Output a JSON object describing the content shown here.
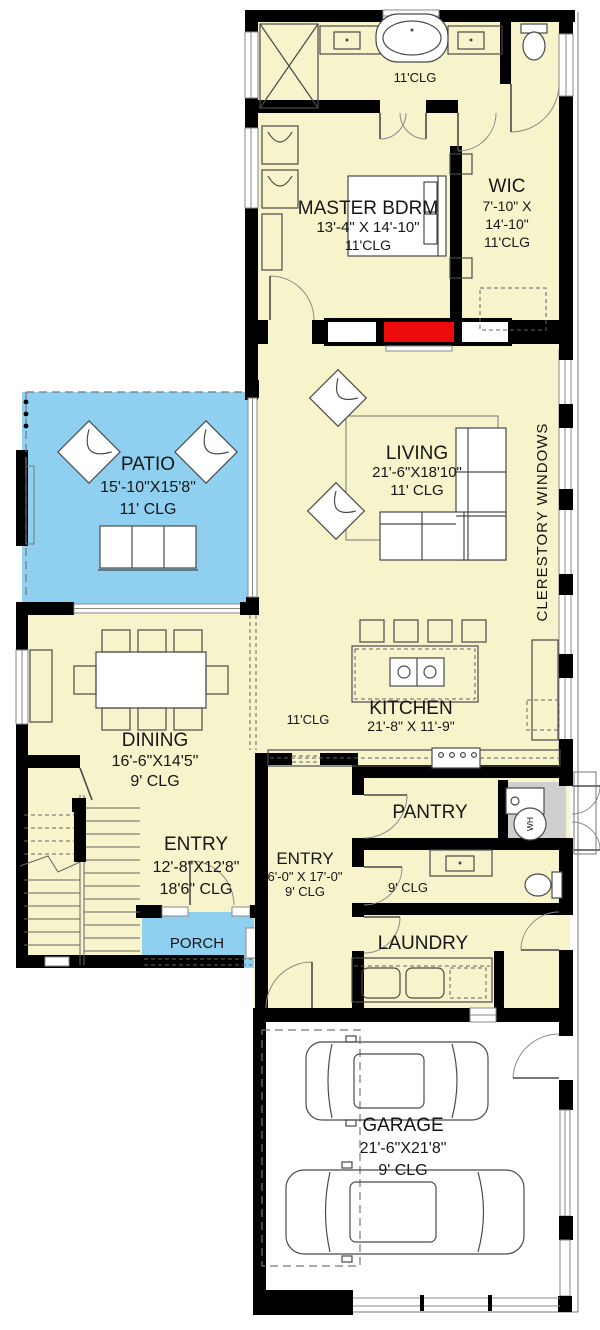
{
  "plan": {
    "colors": {
      "room_fill": "#F7F3CB",
      "outdoor_fill": "#8FD0F0",
      "fireplace_red": "#EE0B0B",
      "utility_gray": "#CFCFCF",
      "wall": "#000000"
    },
    "rooms": {
      "master_bath": {
        "clg": "11'CLG"
      },
      "master_bedroom": {
        "name": "MASTER BDRM",
        "dims": "13'-4\" X 14'-10\"",
        "clg": "11'CLG"
      },
      "wic": {
        "name": "WIC",
        "dims1": "7'-10\" X",
        "dims2": "14'-10\"",
        "clg": "11'CLG"
      },
      "living": {
        "name": "LIVING",
        "dims": "21'-6\"X18'10\"",
        "clg": "11' CLG"
      },
      "patio": {
        "name": "PATIO",
        "dims": "15'-10\"X15'8\"",
        "clg": "11' CLG"
      },
      "dining": {
        "name": "DINING",
        "dims": "16'-6\"X14'5\"",
        "clg": "9' CLG"
      },
      "kitchen": {
        "name": "KITCHEN",
        "dims": "21'-8\" X 11'-9\"",
        "zone_clg": "11'CLG"
      },
      "entry_main": {
        "name": "ENTRY",
        "dims": "12'-8\"X12'8\"",
        "clg": "18'6\" CLG"
      },
      "entry_side": {
        "name": "ENTRY",
        "dims": "6'-0\" X 17'-0\"",
        "clg": "9' CLG"
      },
      "pantry": {
        "name": "PANTRY"
      },
      "powder": {
        "clg": "9' CLG"
      },
      "laundry": {
        "name": "LAUNDRY"
      },
      "porch": {
        "name": "PORCH"
      },
      "garage": {
        "name": "GARAGE",
        "dims": "21'-6\"X21'8\"",
        "clg": "9' CLG"
      },
      "water_heater": {
        "label": "WH"
      },
      "clerestory": {
        "label": "CLERESTORY WINDOWS"
      }
    }
  }
}
